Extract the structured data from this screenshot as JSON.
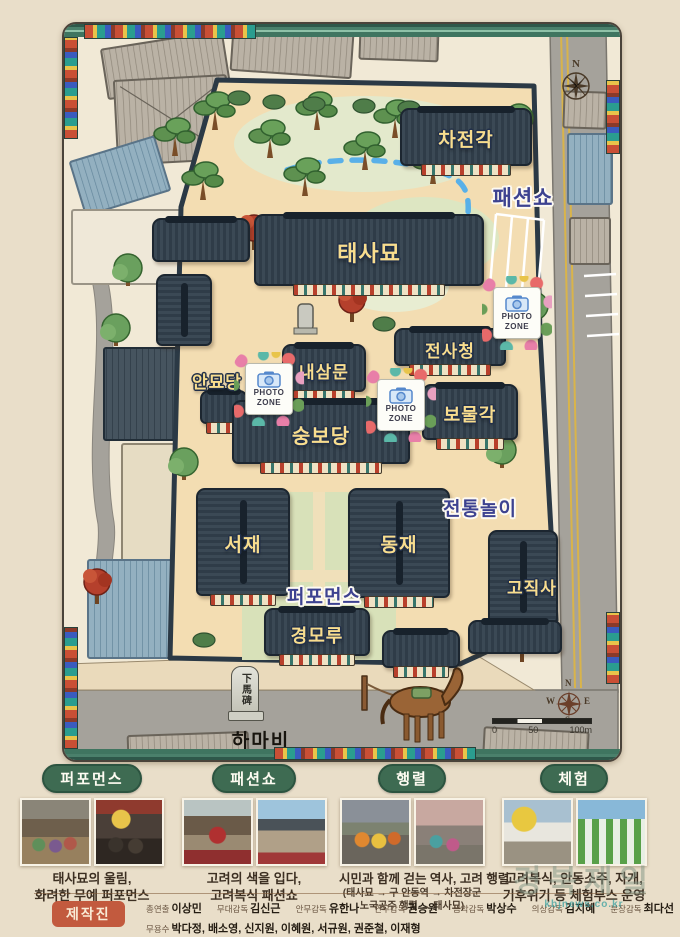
{
  "map": {
    "buildings": [
      {
        "id": "chajeongak",
        "label": "차전각"
      },
      {
        "id": "taesamyo",
        "label": "태사묘"
      },
      {
        "id": "jeonsacheong",
        "label": "전사청"
      },
      {
        "id": "naesammun",
        "label": "내삼문"
      },
      {
        "id": "anmyodang",
        "label": "안묘당"
      },
      {
        "id": "bomulgak",
        "label": "보물각"
      },
      {
        "id": "sungbodang",
        "label": "숭보당"
      },
      {
        "id": "seojae",
        "label": "서재"
      },
      {
        "id": "dongjae",
        "label": "동재"
      },
      {
        "id": "gojiksa",
        "label": "고직사"
      },
      {
        "id": "gyeongmoru",
        "label": "경모루"
      }
    ],
    "event_labels": [
      {
        "id": "fashion-show",
        "label": "패션쇼"
      },
      {
        "id": "traditional-games",
        "label": "전통놀이"
      },
      {
        "id": "performance",
        "label": "퍼포먼스"
      }
    ],
    "photo_zone": {
      "line1": "PHOTO",
      "line2": "ZONE"
    },
    "hamabi": {
      "stone": "下馬碑",
      "label": "하마비"
    },
    "compass_top": {
      "n": "N"
    },
    "compass_bottom": {
      "n": "N",
      "e": "E",
      "s": "S",
      "w": "W"
    },
    "scale_bar": {
      "zero": "0",
      "fifty": "50",
      "hundred": "100m"
    }
  },
  "events": [
    {
      "badge": "퍼포먼스",
      "lines": [
        "태사묘의 울림,",
        "화려한 무예 퍼포먼스"
      ]
    },
    {
      "badge": "패션쇼",
      "lines": [
        "고려의 색을 입다,",
        "고려복식 패션쇼"
      ]
    },
    {
      "badge": "행렬",
      "lines": [
        "시민과 함께 걷는 역사, 고려 행렬"
      ],
      "route": [
        "(태사묘 → 구 안동역 → 차전장군",
        "노국공주 행렬 → 태사묘)"
      ]
    },
    {
      "badge": "체험",
      "lines": [
        "고려복식, 안동소주, 자개,",
        "기후위기 등 체험부스 운영"
      ]
    }
  ],
  "credits": {
    "badge": "제작진",
    "row1": [
      {
        "role": "총연출",
        "name": "이상민"
      },
      {
        "role": "무대감독",
        "name": "김신근"
      },
      {
        "role": "안무감독",
        "name": "유한나"
      },
      {
        "role": "안무감독",
        "name": "권승원"
      },
      {
        "role": "음악감독",
        "name": "박상수"
      },
      {
        "role": "의상감독",
        "name": "김지혜"
      },
      {
        "role": "분장감독",
        "name": "최다선"
      }
    ],
    "row2": {
      "role": "무용수",
      "names": "박다정, 배소영, 신지원, 이혜원, 서규원, 권준철, 이재형"
    }
  },
  "watermark": {
    "text": "경북제일",
    "url": "kbjnews.co.kr"
  },
  "colors": {
    "accent_green": "#3e6b52",
    "accent_red": "#c25a3e",
    "label_gold": "#f6d889",
    "label_navy": "#3d4290",
    "path_blue": "#59b0e8"
  }
}
